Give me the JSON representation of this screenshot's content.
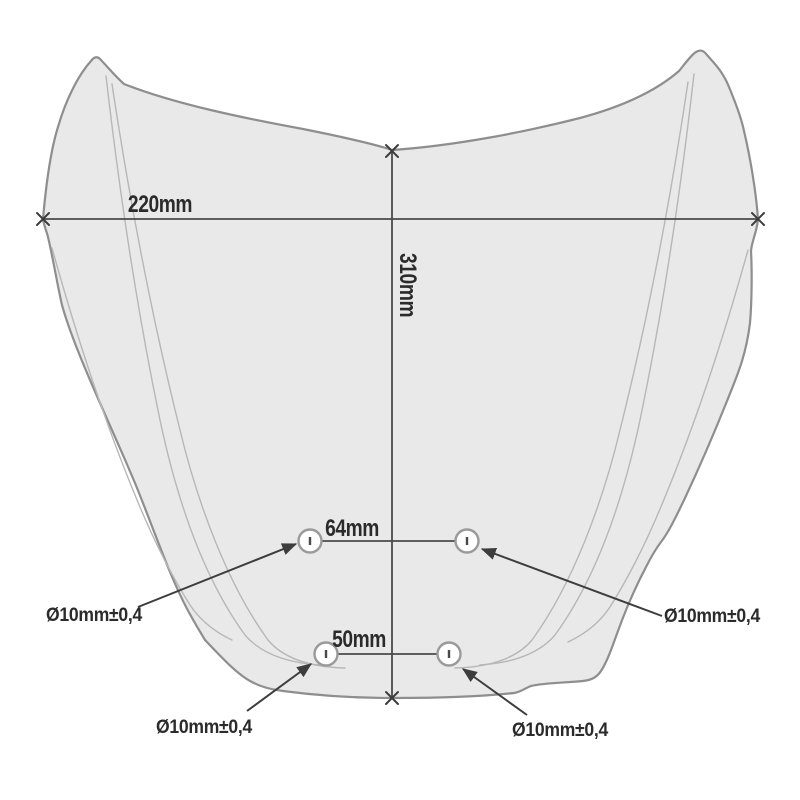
{
  "diagram": {
    "title": "windscreen-mounting-dimensions",
    "labels": {
      "width": "220mm",
      "height": "310mm",
      "upper_spacing": "64mm",
      "lower_spacing": "50mm",
      "hole_mid_left": "Ø10mm±0,4",
      "hole_mid_right": "Ø10mm±0,4",
      "hole_bottom_left": "Ø10mm±0,4",
      "hole_bottom_right": "Ø10mm±0,4"
    },
    "colors": {
      "background": "#ffffff",
      "windscreen_fill": "#e9e9e9",
      "windscreen_outline": "#8e8e8e",
      "crease_line": "#b7b7b7",
      "dimension_line": "#4a4a4a",
      "arrow": "#3d3d3d",
      "text": "#2b2b2b"
    }
  }
}
